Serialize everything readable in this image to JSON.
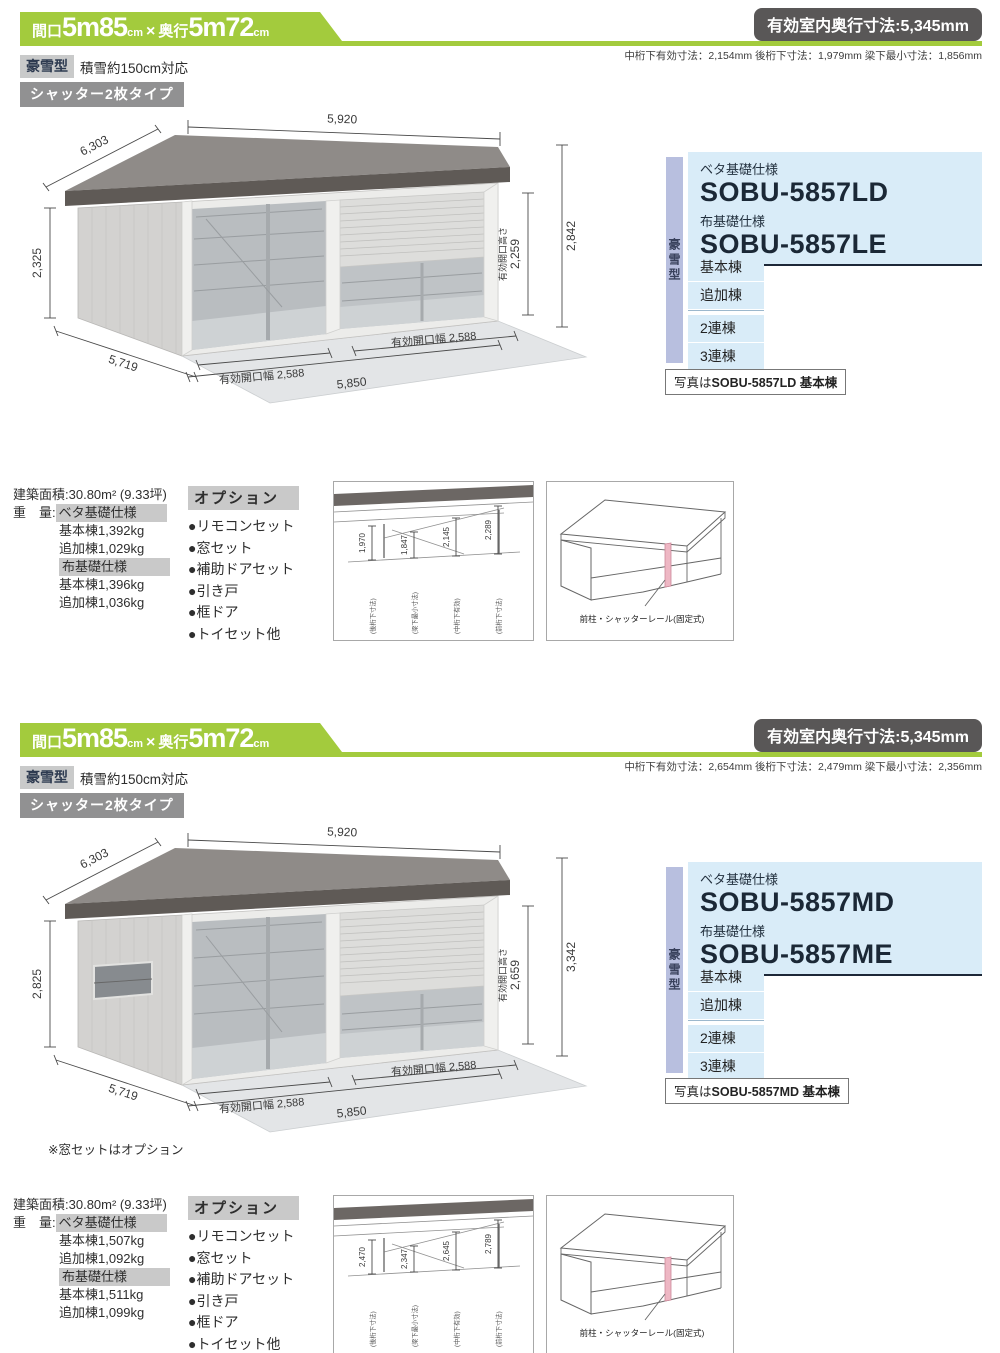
{
  "sections": [
    {
      "header": {
        "size_prefix": "間口",
        "size_w_big": "5m85",
        "size_unit1": "cm",
        "size_times": "×",
        "size_d_label": "奥行",
        "size_d_big": "5m72",
        "size_unit2": "cm",
        "depth_badge": "有効室内奥行寸法:5,345mm",
        "sub_dims": "中桁下有効寸法：2,154mm 後桁下寸法：1,979mm 梁下最小寸法：1,856mm",
        "type_badge": "豪雪型",
        "snow_note": "積雪約150cm対応",
        "shutter_badge": "シャッター2枚タイプ"
      },
      "drawing": {
        "dim_width_top": "5,920",
        "dim_depth_roof": "6,303",
        "dim_height_left": "2,325",
        "dim_depth_bottom": "5,719",
        "dim_width_bottom": "5,850",
        "dim_opening_left": "有効開口幅 2,588",
        "dim_opening_right": "有効開口幅 2,588",
        "dim_opening_height_label": "有効開口高さ",
        "dim_opening_height": "2,259",
        "dim_total_height": "2,842",
        "note": ""
      },
      "models": {
        "tab": "豪雪型",
        "beta_label": "ベタ基礎仕様",
        "beta_model": "SOBU-5857LD",
        "nuno_label": "布基礎仕様",
        "nuno_model": "SOBU-5857LE",
        "unit_rows": [
          "基本棟",
          "追加棟"
        ],
        "multi_rows": [
          "2連棟",
          "3連棟"
        ],
        "caption_prefix": "写真は",
        "caption_bold": "SOBU-5857LD 基本棟"
      },
      "specs": {
        "area_label": "建築面積:",
        "area_value": "30.80m² (9.33坪)",
        "weight_label": "重　量:",
        "beta_header": "ベタ基礎仕様",
        "beta_base": "基本棟1,392kg",
        "beta_add": "追加棟1,029kg",
        "nuno_header": "布基礎仕様",
        "nuno_base": "基本棟1,396kg",
        "nuno_add": "追加棟1,036kg"
      },
      "options": {
        "title": "オプション",
        "items": [
          "●リモコンセット",
          "●窓セット",
          "●補助ドアセット",
          "●引き戸",
          "●框ドア",
          "●トイセット他"
        ]
      },
      "cross_section": {
        "dims": [
          "1,970",
          "1,847",
          "2,145",
          "2,289"
        ],
        "labels": [
          "(後桁下寸法)",
          "(梁下最小寸法)",
          "(中桁下有効)",
          "(前桁下寸法)"
        ]
      },
      "rail_diagram": {
        "label": "前柱・シャッターレール(固定式)"
      }
    },
    {
      "header": {
        "size_prefix": "間口",
        "size_w_big": "5m85",
        "size_unit1": "cm",
        "size_times": "×",
        "size_d_label": "奥行",
        "size_d_big": "5m72",
        "size_unit2": "cm",
        "depth_badge": "有効室内奥行寸法:5,345mm",
        "sub_dims": "中桁下有効寸法：2,654mm 後桁下寸法：2,479mm 梁下最小寸法：2,356mm",
        "type_badge": "豪雪型",
        "snow_note": "積雪約150cm対応",
        "shutter_badge": "シャッター2枚タイプ"
      },
      "drawing": {
        "dim_width_top": "5,920",
        "dim_depth_roof": "6,303",
        "dim_height_left": "2,825",
        "dim_depth_bottom": "5,719",
        "dim_width_bottom": "5,850",
        "dim_opening_left": "有効開口幅 2,588",
        "dim_opening_right": "有効開口幅 2,588",
        "dim_opening_height_label": "有効開口高さ",
        "dim_opening_height": "2,659",
        "dim_total_height": "3,342",
        "note": "※窓セットはオプション"
      },
      "models": {
        "tab": "豪雪型",
        "beta_label": "ベタ基礎仕様",
        "beta_model": "SOBU-5857MD",
        "nuno_label": "布基礎仕様",
        "nuno_model": "SOBU-5857ME",
        "unit_rows": [
          "基本棟",
          "追加棟"
        ],
        "multi_rows": [
          "2連棟",
          "3連棟"
        ],
        "caption_prefix": "写真は",
        "caption_bold": "SOBU-5857MD 基本棟"
      },
      "specs": {
        "area_label": "建築面積:",
        "area_value": "30.80m² (9.33坪)",
        "weight_label": "重　量:",
        "beta_header": "ベタ基礎仕様",
        "beta_base": "基本棟1,507kg",
        "beta_add": "追加棟1,092kg",
        "nuno_header": "布基礎仕様",
        "nuno_base": "基本棟1,511kg",
        "nuno_add": "追加棟1,099kg"
      },
      "options": {
        "title": "オプション",
        "items": [
          "●リモコンセット",
          "●窓セット",
          "●補助ドアセット",
          "●引き戸",
          "●框ドア",
          "●トイセット他"
        ]
      },
      "cross_section": {
        "dims": [
          "2,470",
          "2,347",
          "2,645",
          "2,789"
        ],
        "labels": [
          "(後桁下寸法)",
          "(梁下最小寸法)",
          "(中桁下有効)",
          "(前桁下寸法)"
        ]
      },
      "rail_diagram": {
        "label": "前柱・シャッターレール(固定式)"
      }
    }
  ]
}
